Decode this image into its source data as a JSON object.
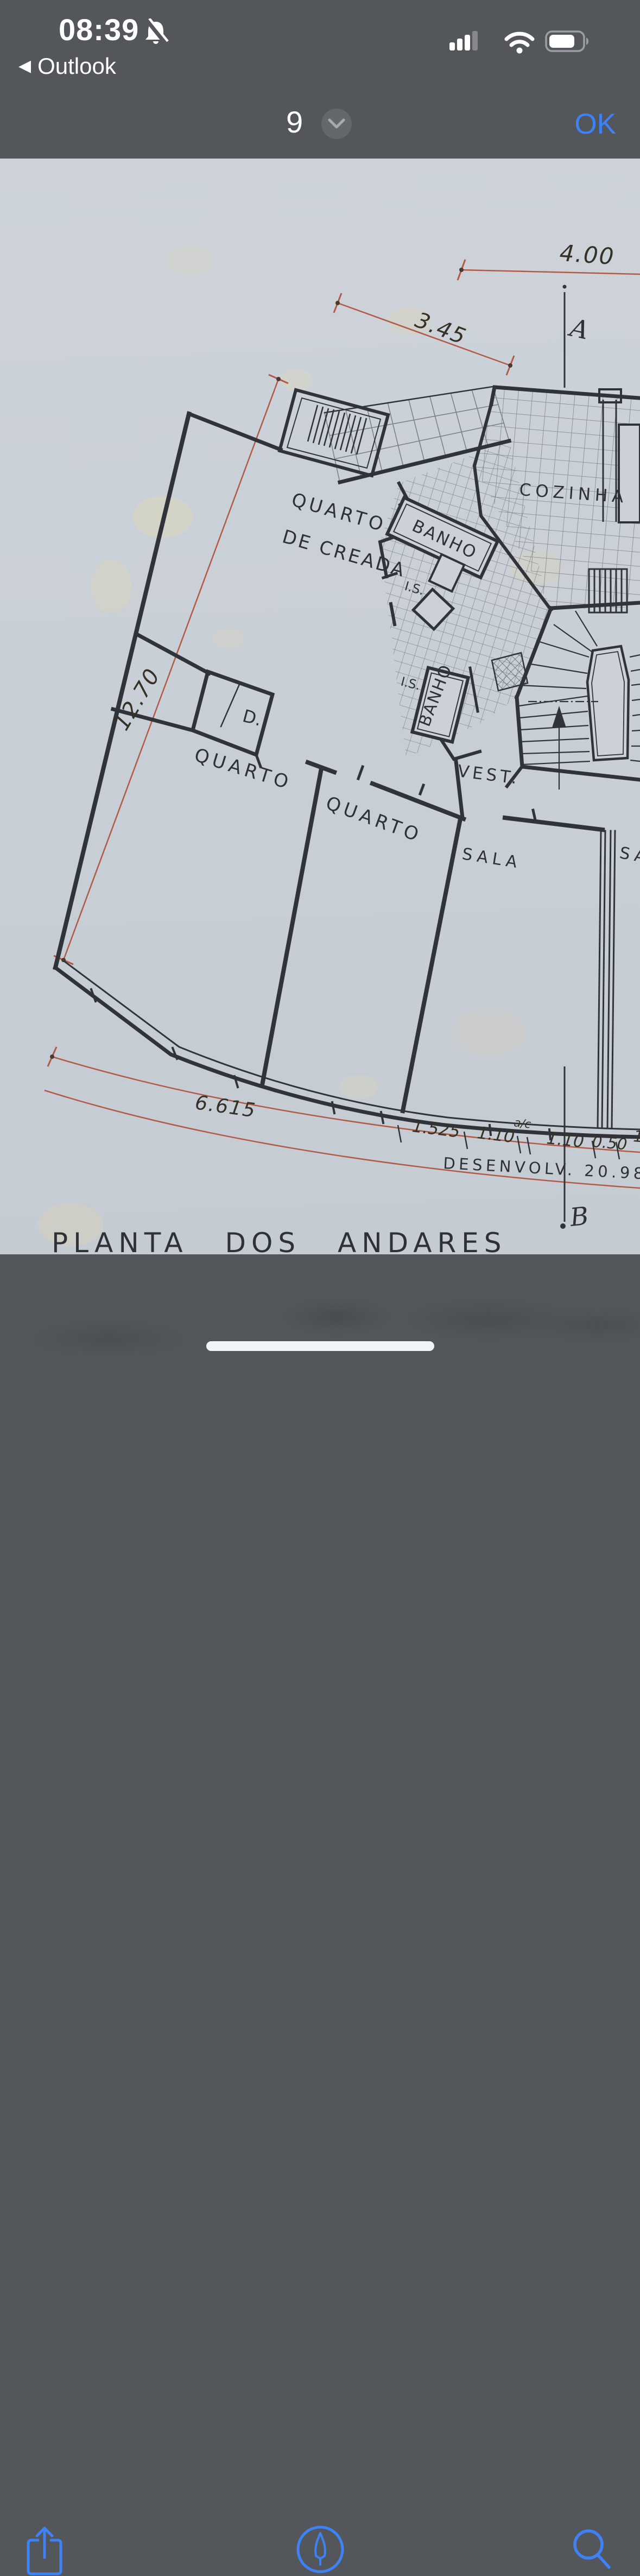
{
  "status_bar": {
    "time": "08:39",
    "back_label": "Outlook",
    "bell_icon": "bell-slash",
    "signal_bars_filled": "3 of 4",
    "battery_percent_estimate": "70"
  },
  "nav_bar": {
    "page_indicator": "9",
    "ok_label": "OK",
    "chevron_icon": "chevron-down"
  },
  "toolbar": {
    "share_icon": "share-icon",
    "markup_icon": "markup-icon",
    "search_icon": "search-icon"
  },
  "colors": {
    "chrome_gray": "#53575b",
    "accent_blue": "#3f82f7",
    "paper": "#c9cfd6",
    "ink": "#30343a",
    "dimension_red": "#b25a46"
  },
  "plan": {
    "title": "PLANTA  DOS  ANDARES",
    "axis_top": "A",
    "axis_bottom": "B",
    "rooms": {
      "maid_line1": "QUARTO",
      "maid_line2": "DE CREADA",
      "bath1": "BANHO",
      "wc1": "I.S.",
      "kitchen": "COZINHA",
      "bath2": "BANHO",
      "wc2": "I.S.",
      "closet": "D.",
      "bedroom1": "QUARTO",
      "bedroom2": "QUARTO",
      "vestibule": "VEST.",
      "living1": "SALA",
      "living2_partial": "SA"
    },
    "dimensions": {
      "top": "4.00",
      "diagonal": "3.45",
      "left": "12.70",
      "bottom": "6.615",
      "arc_seg1": "1.525",
      "arc_seg2": "1.10",
      "arc_note": "a/c",
      "arc_seg3": "1.10",
      "arc_seg4": "0.50",
      "arc_seg5": "1",
      "development": "DESENVOLV. 20.98"
    }
  }
}
